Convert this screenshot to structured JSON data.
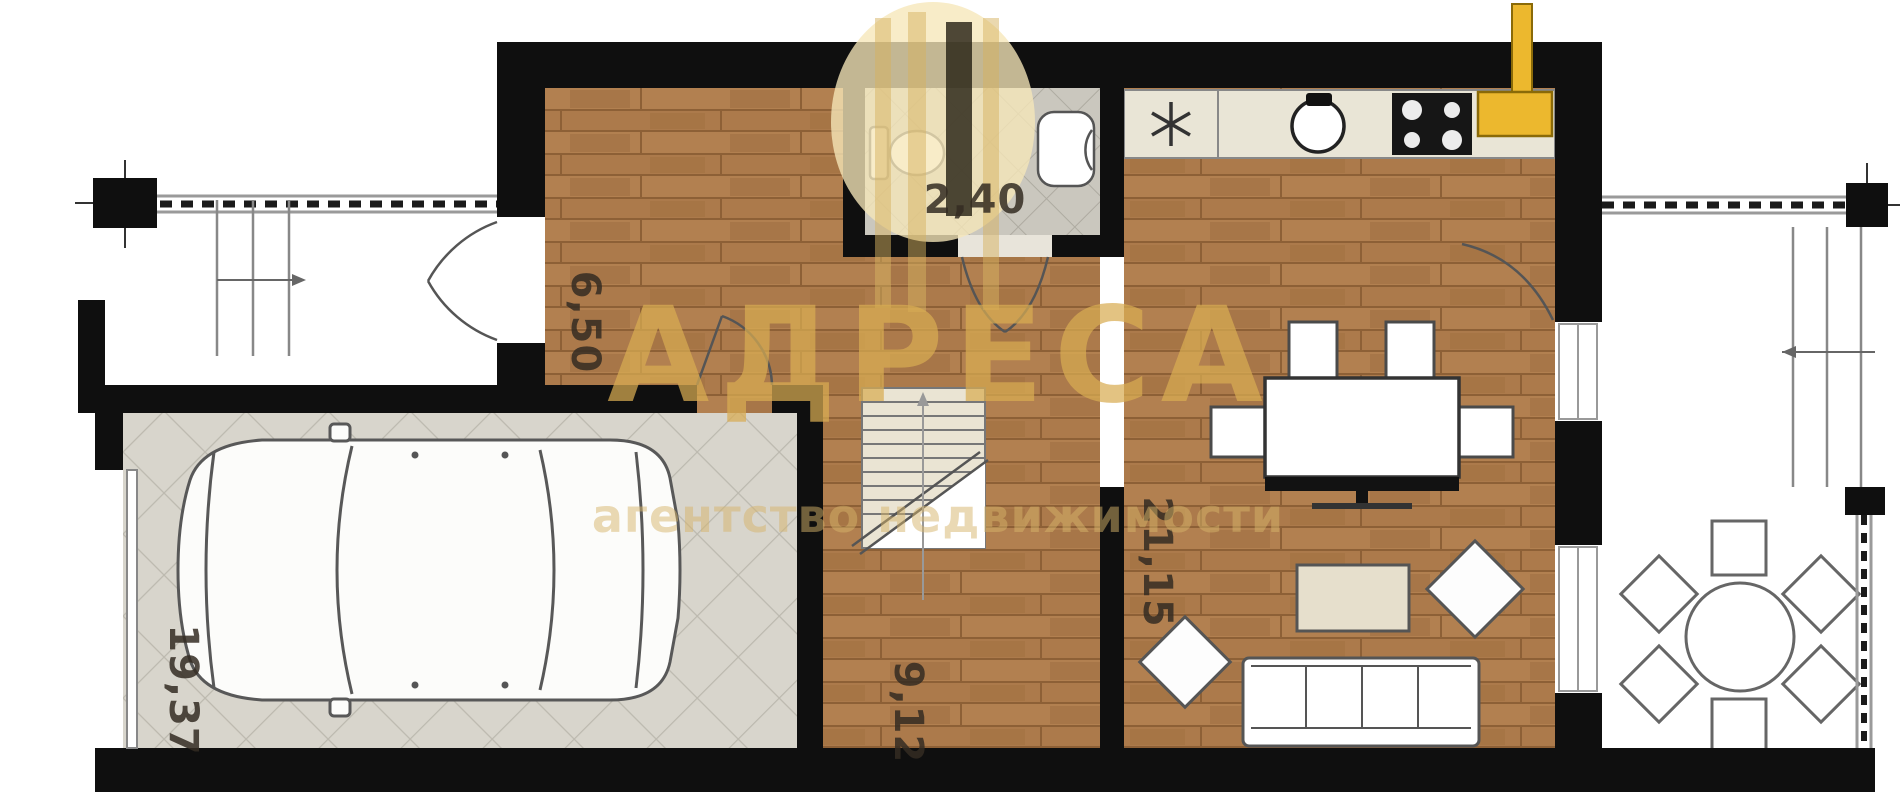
{
  "watermark": {
    "brand": "АДРЕСА",
    "tagline": "агентство недвижимости",
    "gold": "#d8ac52"
  },
  "rooms": [
    {
      "id": "entry-hall",
      "area": "6,50"
    },
    {
      "id": "bathroom",
      "area": "2,40"
    },
    {
      "id": "living-room",
      "area": "21,15"
    },
    {
      "id": "stair-hall",
      "area": "9,12"
    },
    {
      "id": "garage",
      "area": "19,37"
    }
  ],
  "colors": {
    "wall": "#0f0f0f",
    "wood_floor": "#ac7a4b",
    "tile_floor": "#cac7be",
    "garage_floor": "#d8d5cc",
    "counter": "#e9e5d6",
    "accent_yellow": "#ecb82e"
  }
}
